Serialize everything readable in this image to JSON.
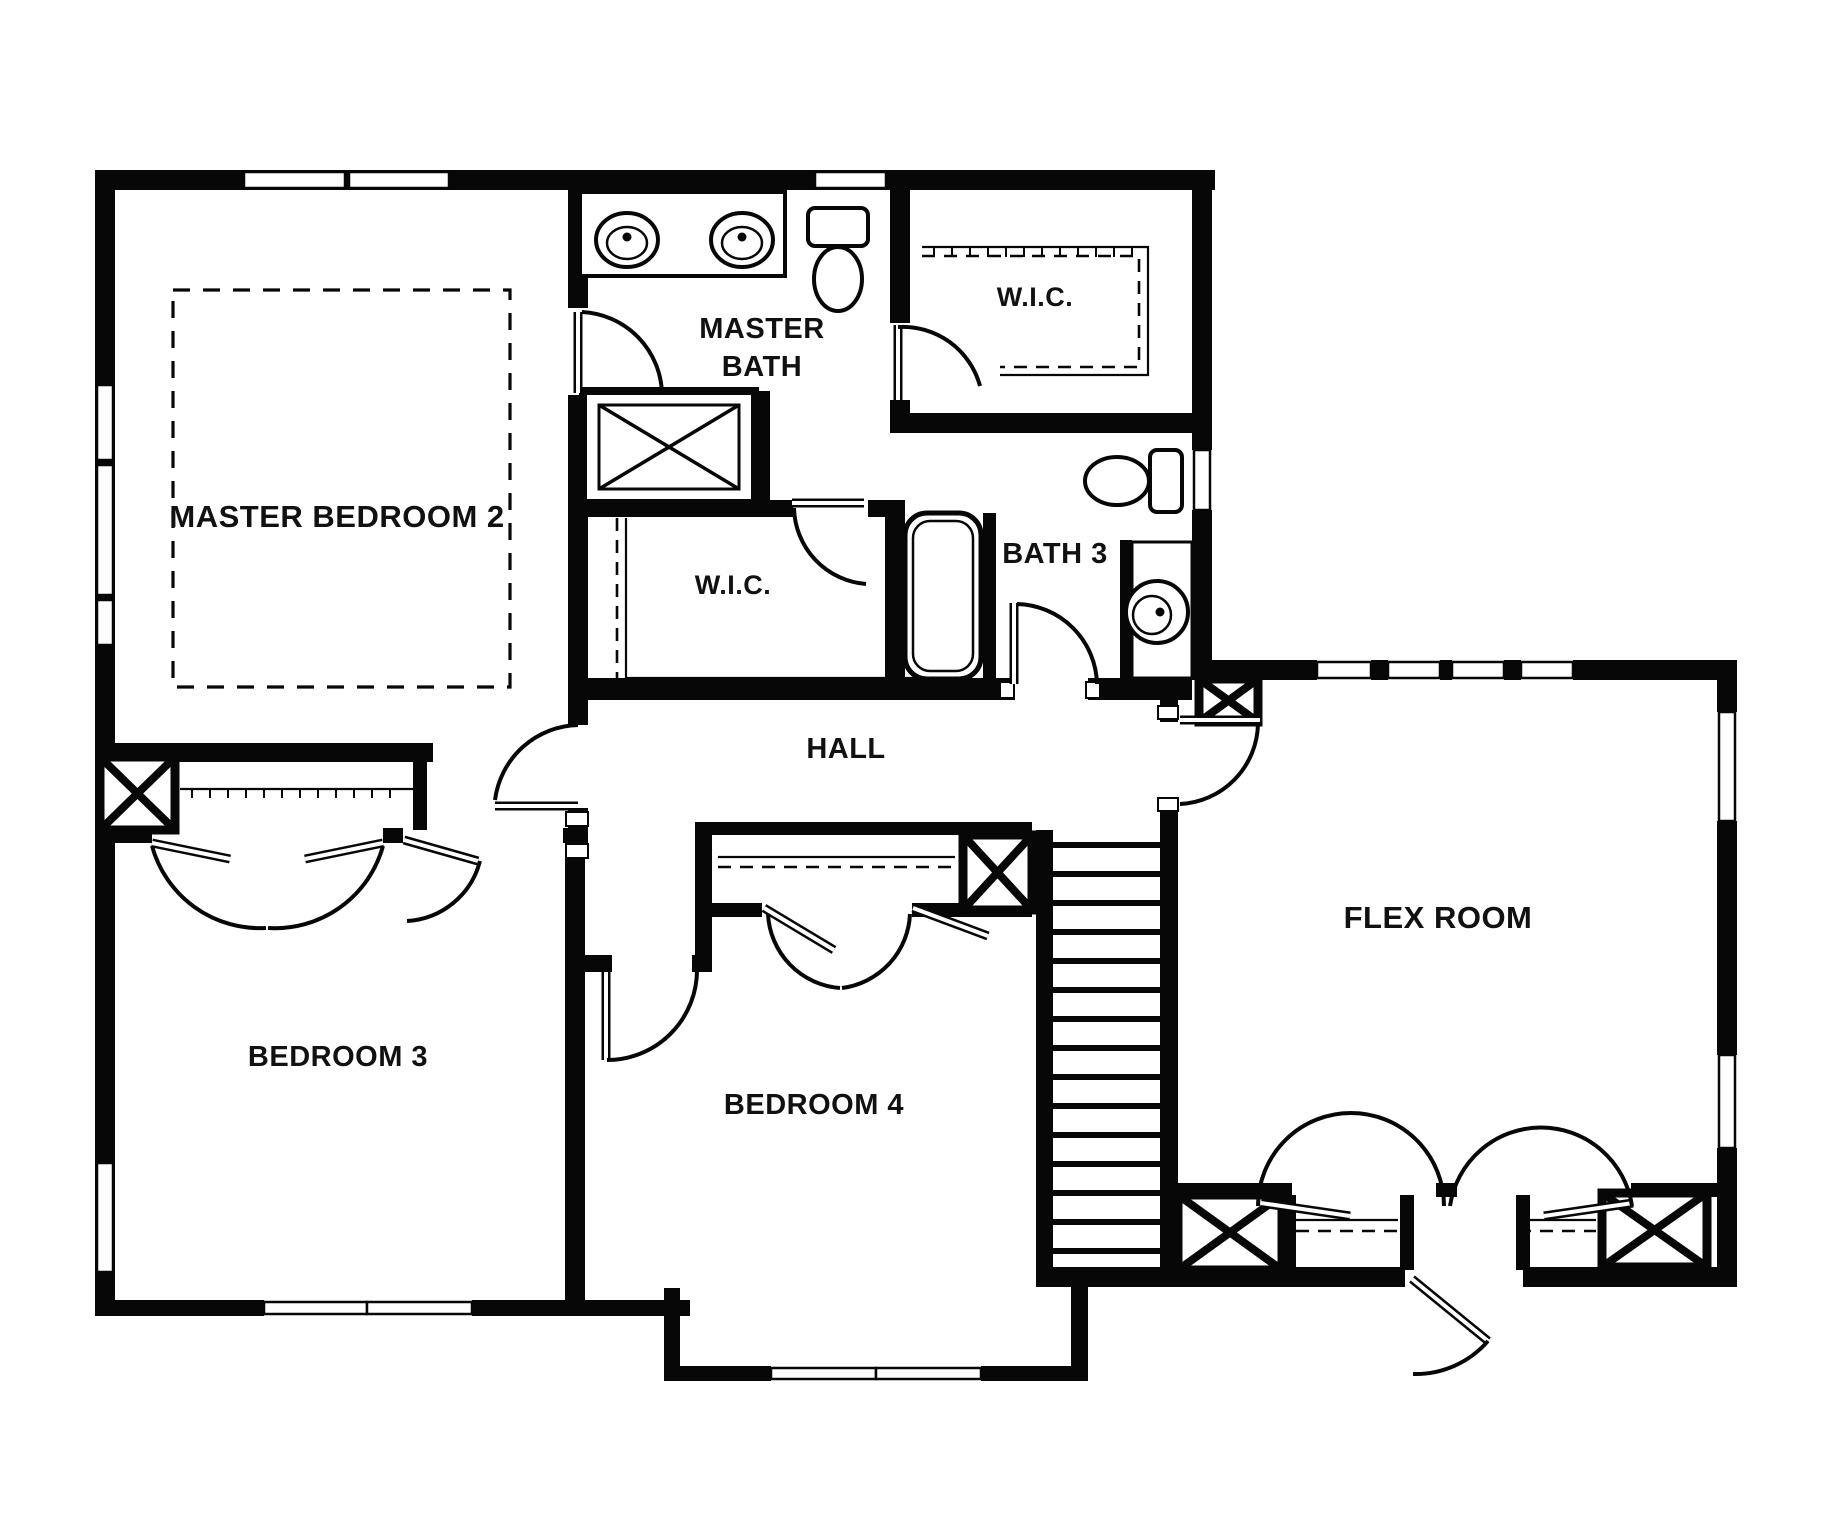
{
  "drawing": {
    "type": "floor-plan",
    "style": "black-and-white architectural plan, second floor"
  },
  "colors": {
    "wall": "#070707",
    "background": "#ffffff",
    "label": "#111111"
  },
  "rooms": {
    "master_bedroom_2": "MASTER BEDROOM 2",
    "master_bath_line_1": "MASTER",
    "master_bath_line_2": "BATH",
    "wic_upper": "W.I.C.",
    "wic_master": "W.I.C.",
    "bath_3": "BATH 3",
    "hall": "HALL",
    "bedroom_3": "BEDROOM 3",
    "bedroom_4": "BEDROOM 4",
    "flex_room": "FLEX ROOM"
  },
  "fixtures": {
    "double_vanity": "double-vanity-sinks",
    "master_toilet": "toilet",
    "shower": "walk-in-shower",
    "bathtub": "bathtub",
    "bath3_toilet": "toilet",
    "bath3_sink": "round-vanity-sink",
    "stairs": "staircase",
    "bed": "optional-bed-outline"
  }
}
